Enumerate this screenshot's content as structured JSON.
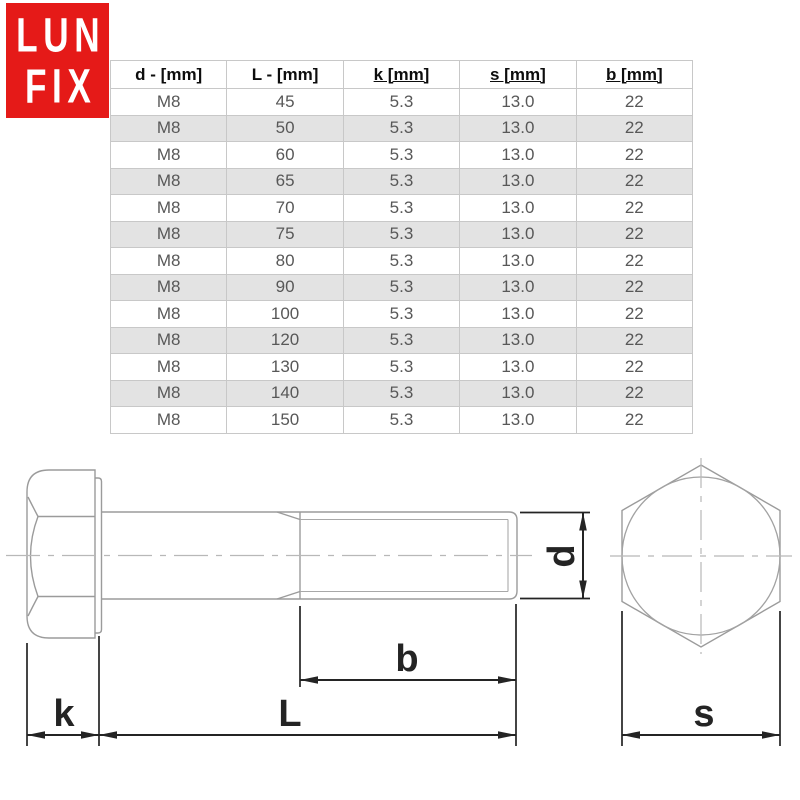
{
  "logo": {
    "line1": "LUN",
    "line2": "FIX",
    "bg_color": "#e51a18",
    "text_color": "#ffffff"
  },
  "table": {
    "columns": [
      {
        "label": "d - [mm]",
        "underline": false
      },
      {
        "label": "L - [mm]",
        "underline": false
      },
      {
        "label": "k [mm]",
        "underline": true
      },
      {
        "label": "s [mm]",
        "underline": true
      },
      {
        "label": "b [mm]",
        "underline": true
      }
    ],
    "rows": [
      [
        "M8",
        "45",
        "5.3",
        "13.0",
        "22"
      ],
      [
        "M8",
        "50",
        "5.3",
        "13.0",
        "22"
      ],
      [
        "M8",
        "60",
        "5.3",
        "13.0",
        "22"
      ],
      [
        "M8",
        "65",
        "5.3",
        "13.0",
        "22"
      ],
      [
        "M8",
        "70",
        "5.3",
        "13.0",
        "22"
      ],
      [
        "M8",
        "75",
        "5.3",
        "13.0",
        "22"
      ],
      [
        "M8",
        "80",
        "5.3",
        "13.0",
        "22"
      ],
      [
        "M8",
        "90",
        "5.3",
        "13.0",
        "22"
      ],
      [
        "M8",
        "100",
        "5.3",
        "13.0",
        "22"
      ],
      [
        "M8",
        "120",
        "5.3",
        "13.0",
        "22"
      ],
      [
        "M8",
        "130",
        "5.3",
        "13.0",
        "22"
      ],
      [
        "M8",
        "140",
        "5.3",
        "13.0",
        "22"
      ],
      [
        "M8",
        "150",
        "5.3",
        "13.0",
        "22"
      ]
    ],
    "stripe_color": "#e3e3e3",
    "border_color": "#c8c8c8"
  },
  "drawing": {
    "labels": {
      "k": "k",
      "L": "L",
      "b": "b",
      "d": "d",
      "s": "s"
    },
    "outline_color": "#9b9b9b",
    "centerline_color": "#b8b8b8",
    "dimension_color": "#242424"
  }
}
